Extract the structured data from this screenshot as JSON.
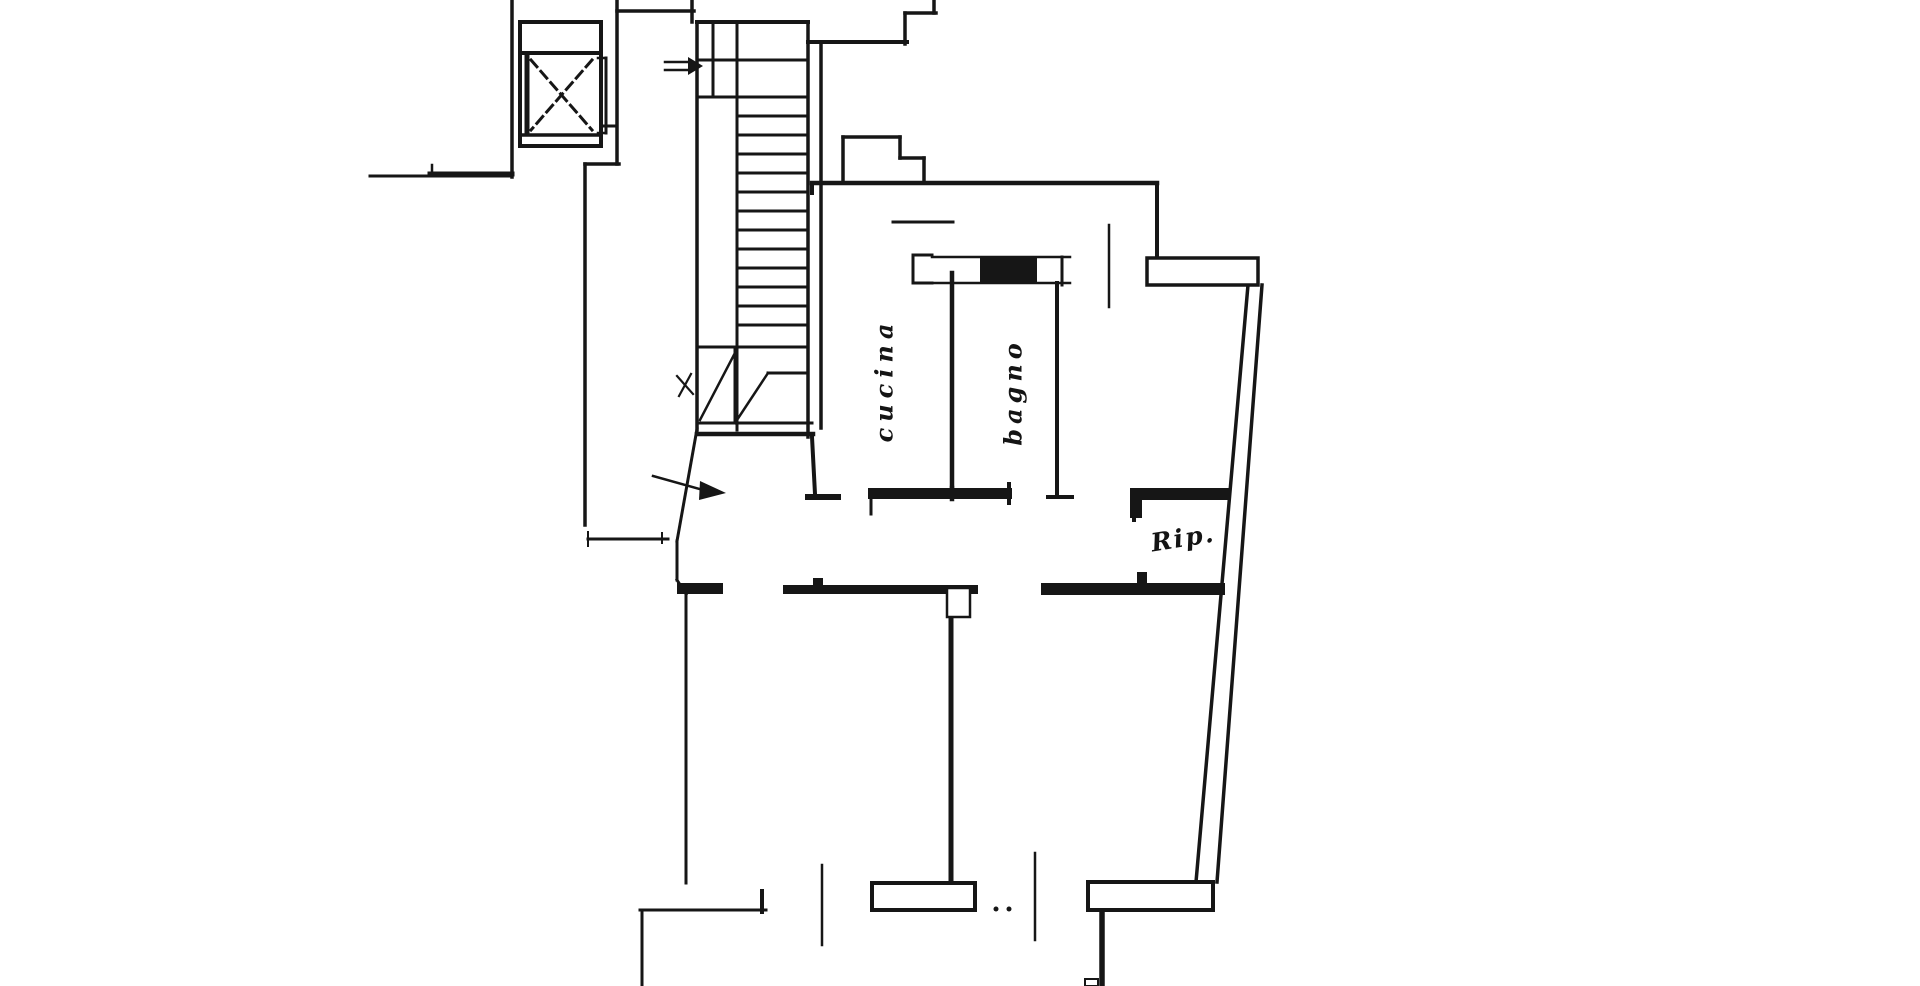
{
  "document": {
    "kind": "scanned floor plan",
    "background": "#ffffff",
    "ink": "#161616"
  },
  "rooms": [
    {
      "name": "cucina",
      "label": "cucina"
    },
    {
      "name": "bagno",
      "label": "bagno"
    },
    {
      "name": "ripostiglio",
      "label": "Rip."
    }
  ],
  "symbols": {
    "elevator_cross": "dashed X inside elevator shaft",
    "entry_arrow": "arrow through front door at stair landing",
    "stair_direction_arrow": "small arrow at top of stair run"
  },
  "drawing": {
    "lines": [
      [
        512,
        0,
        512,
        177,
        3.5
      ],
      [
        370,
        176,
        512,
        176,
        3
      ],
      [
        430,
        174,
        512,
        174,
        5
      ],
      [
        432,
        165,
        432,
        176,
        2.5
      ],
      [
        617,
        0,
        617,
        164,
        3.5
      ],
      [
        585,
        164,
        619,
        164,
        3.5
      ],
      [
        585,
        164,
        585,
        525,
        3.5
      ],
      [
        601,
        126,
        617,
        126,
        3
      ],
      [
        617,
        11,
        694,
        11,
        3.5
      ],
      [
        692,
        0,
        692,
        22,
        3.5
      ],
      [
        905,
        13,
        936,
        13,
        3.5
      ],
      [
        934,
        0,
        934,
        13,
        3.5
      ],
      [
        905,
        13,
        905,
        44,
        3.5
      ],
      [
        808,
        42,
        907,
        42,
        4
      ],
      [
        697,
        22,
        808,
        22,
        4
      ],
      [
        697,
        22,
        697,
        430,
        3.5
      ],
      [
        808,
        22,
        808,
        437,
        3.5
      ],
      [
        821,
        42,
        821,
        428,
        3.5
      ],
      [
        713,
        22,
        713,
        97,
        3
      ],
      [
        737,
        22,
        737,
        430,
        3
      ],
      [
        697,
        60,
        808,
        60,
        3
      ],
      [
        697,
        97,
        808,
        97,
        3
      ],
      [
        697,
        347,
        808,
        347,
        3
      ],
      [
        735,
        347,
        735,
        423,
        3
      ],
      [
        768,
        373,
        808,
        373,
        3
      ],
      [
        737,
        349,
        700,
        420,
        2.5
      ],
      [
        735,
        423,
        768,
        373,
        2.5
      ],
      [
        697,
        423,
        812,
        423,
        3
      ],
      [
        697,
        434,
        813,
        434,
        4.5
      ],
      [
        812,
        437,
        815,
        494,
        4
      ],
      [
        808,
        497,
        838,
        497,
        6
      ],
      [
        697,
        429,
        677,
        541,
        3
      ],
      [
        677,
        376,
        693,
        394,
        2.2
      ],
      [
        691,
        374,
        679,
        396,
        2.2
      ],
      [
        677,
        541,
        677,
        580,
        3
      ],
      [
        677,
        580,
        686,
        594,
        3
      ],
      [
        686,
        594,
        686,
        883,
        3
      ],
      [
        640,
        910,
        766,
        910,
        3
      ],
      [
        642,
        910,
        642,
        986,
        3
      ],
      [
        588,
        532,
        588,
        546,
        2
      ],
      [
        588,
        539,
        668,
        539,
        3
      ],
      [
        662,
        533,
        662,
        543,
        2
      ],
      [
        762,
        891,
        762,
        912,
        4
      ],
      [
        822,
        865,
        822,
        945,
        2.5
      ],
      [
        1035,
        853,
        1035,
        940,
        2.5
      ],
      [
        951,
        594,
        951,
        883,
        5
      ],
      [
        1102,
        910,
        1102,
        986,
        5.5
      ],
      [
        952,
        273,
        952,
        488,
        4.5
      ],
      [
        952,
        488,
        952,
        499,
        4.5
      ],
      [
        1057,
        283,
        1057,
        497,
        4
      ],
      [
        1048,
        497,
        1072,
        497,
        4
      ],
      [
        932,
        257,
        1070,
        257,
        2.5
      ],
      [
        932,
        283,
        1070,
        283,
        2.5
      ],
      [
        1062,
        257,
        1062,
        285,
        3
      ],
      [
        913,
        255,
        913,
        283,
        3
      ],
      [
        913,
        255,
        932,
        255,
        3
      ],
      [
        913,
        283,
        932,
        283,
        3
      ],
      [
        812,
        183,
        1157,
        183,
        4.5
      ],
      [
        812,
        183,
        812,
        193,
        4
      ],
      [
        1157,
        183,
        1157,
        260,
        4
      ],
      [
        843,
        137,
        843,
        181,
        3.5
      ],
      [
        843,
        137,
        900,
        137,
        3.5
      ],
      [
        900,
        137,
        900,
        158,
        3.5
      ],
      [
        900,
        158,
        924,
        158,
        3.5
      ],
      [
        924,
        158,
        924,
        181,
        3.5
      ],
      [
        893,
        222,
        953,
        222,
        3
      ],
      [
        1109,
        225,
        1109,
        307,
        2.5
      ],
      [
        871,
        499,
        871,
        514,
        3
      ],
      [
        1009,
        484,
        1009,
        503,
        4
      ],
      [
        1134,
        500,
        1134,
        520,
        4
      ],
      [
        1248,
        285,
        1196,
        882,
        3.5
      ],
      [
        1262,
        285,
        1217,
        882,
        3.5
      ],
      [
        520,
        53,
        601,
        53,
        4
      ],
      [
        527,
        56,
        527,
        134,
        5
      ],
      [
        523,
        135,
        598,
        135,
        3.5
      ],
      [
        606,
        58,
        606,
        133,
        3
      ],
      [
        598,
        58,
        606,
        58,
        2.5
      ],
      [
        598,
        133,
        606,
        133,
        2.5
      ],
      [
        653,
        476,
        703,
        490,
        2.5
      ],
      [
        665,
        62,
        688,
        62,
        2.5
      ],
      [
        665,
        70,
        688,
        70,
        2.5
      ]
    ],
    "stair_treads": {
      "x1": 737,
      "x2": 808,
      "y_start": 116,
      "step": 19,
      "count": 12,
      "w": 3
    },
    "dashed_lines": [
      [
        531,
        60,
        592,
        130,
        3
      ],
      [
        592,
        60,
        531,
        130,
        3
      ]
    ],
    "filled_rects": [
      [
        677,
        583,
        46,
        11
      ],
      [
        783,
        585,
        195,
        9
      ],
      [
        813,
        578,
        10,
        8
      ],
      [
        1041,
        583,
        184,
        12
      ],
      [
        1137,
        572,
        10,
        11
      ],
      [
        868,
        488,
        144,
        11
      ],
      [
        980,
        257,
        57,
        26
      ],
      [
        1130,
        488,
        99,
        12
      ],
      [
        1130,
        488,
        12,
        30
      ]
    ],
    "outlined_rects": [
      [
        520,
        22,
        81,
        124,
        4,
        "none"
      ],
      [
        872,
        883,
        103,
        27,
        4,
        "#ffffff"
      ],
      [
        1088,
        882,
        125,
        28,
        4,
        "#ffffff"
      ],
      [
        947,
        588,
        23,
        29,
        2.5,
        "#ffffff"
      ],
      [
        1147,
        258,
        111,
        27,
        3.5,
        "#ffffff"
      ],
      [
        1085,
        979,
        13,
        7,
        2,
        "none"
      ]
    ],
    "polygons": [
      [
        700,
        481,
        726,
        493,
        699,
        500
      ],
      [
        688,
        57,
        703,
        66,
        688,
        75
      ]
    ],
    "dots": [
      [
        996,
        909,
        2.5
      ],
      [
        1009,
        909,
        2.5
      ]
    ]
  }
}
